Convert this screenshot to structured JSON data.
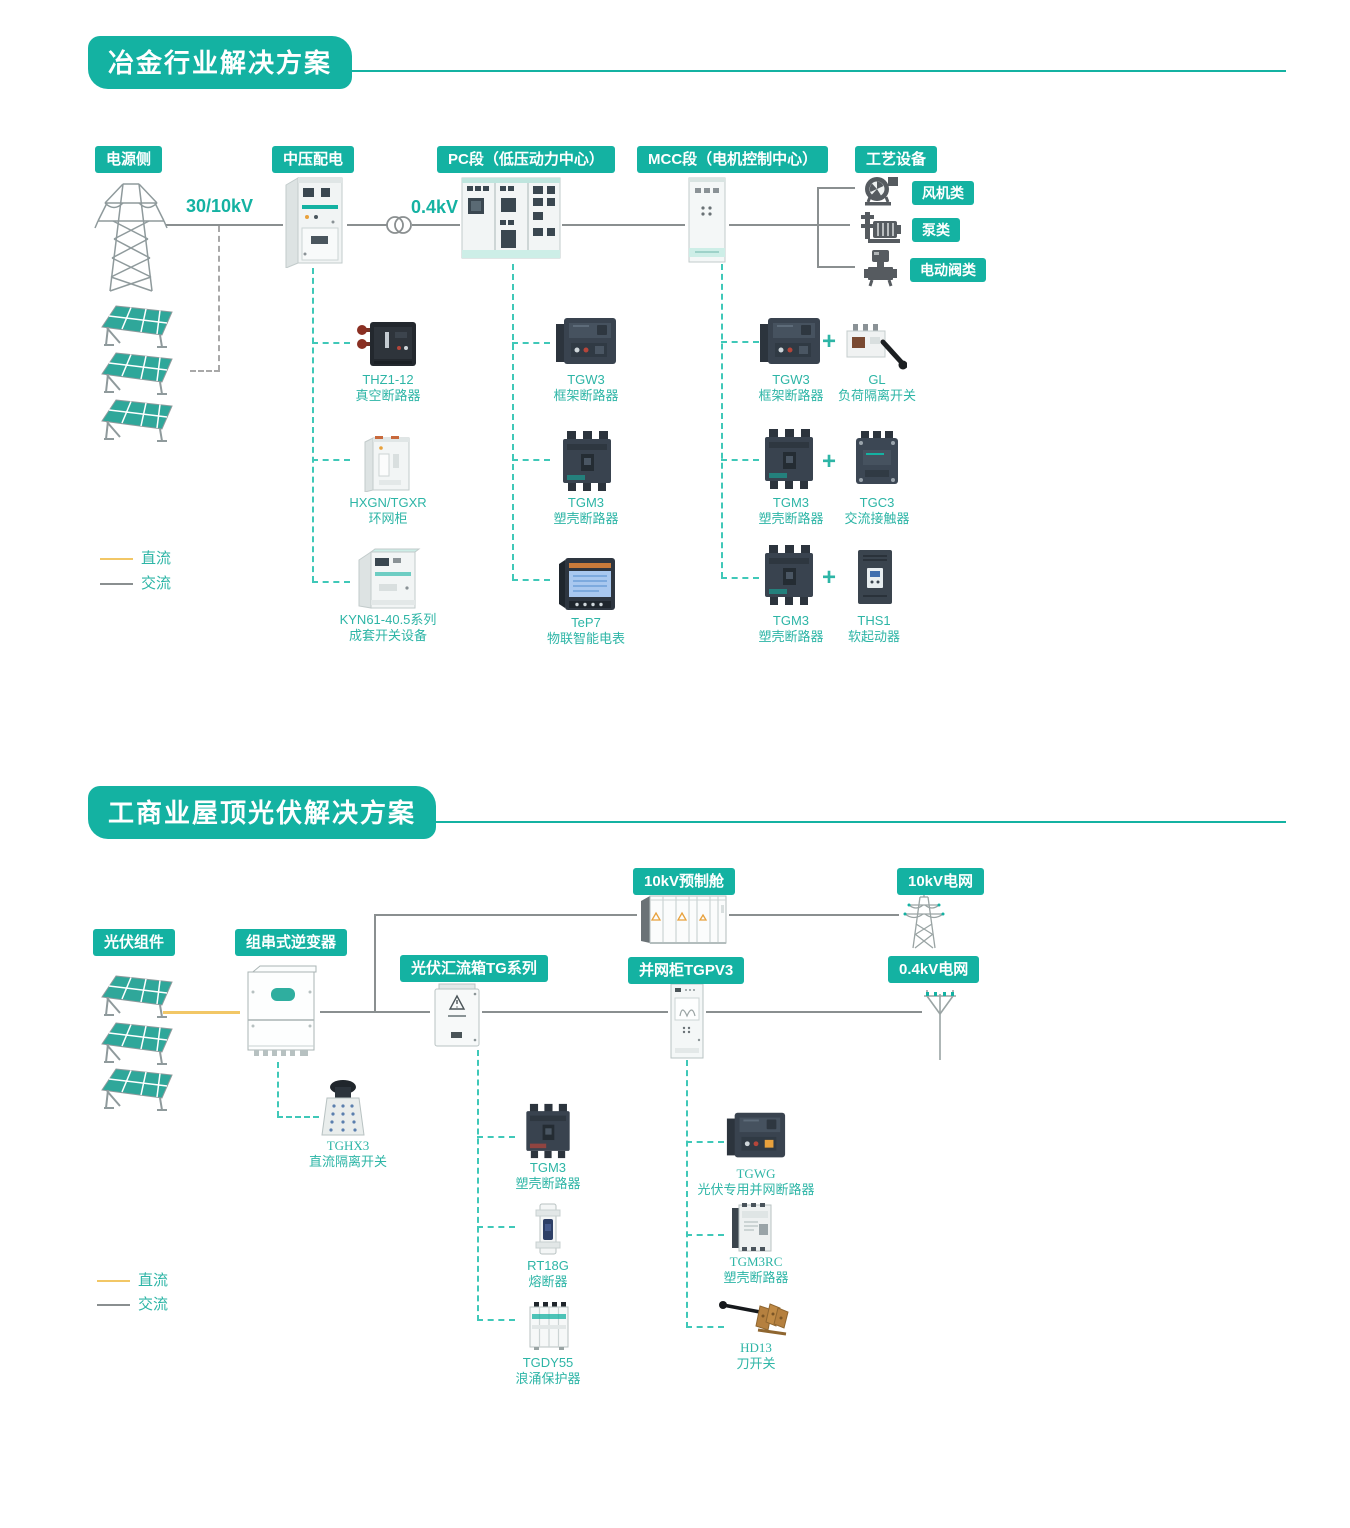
{
  "colors": {
    "accent": "#14b2a2",
    "product_label": "#2db5a6",
    "dc_line": "#f2c766",
    "ac_line": "#8a8f90",
    "teal_dash": "#3fc8b8"
  },
  "s1": {
    "title": "冶金行业解决方案",
    "badges": {
      "power": "电源侧",
      "mv": "中压配电",
      "pc": "PC段（低压动力中心）",
      "mcc": "MCC段（电机控制中心）",
      "process": "工艺设备"
    },
    "voltage_in": "30/10kV",
    "voltage_out": "0.4kV",
    "process_types": [
      {
        "label": "风机类",
        "icon": "fan-icon"
      },
      {
        "label": "泵类",
        "icon": "pump-icon"
      },
      {
        "label": "电动阀类",
        "icon": "motor-valve-icon"
      }
    ],
    "mv_products": [
      {
        "model": "THZ1-12",
        "name": "真空断路器"
      },
      {
        "model": "HXGN/TGXR",
        "name": "环网柜"
      },
      {
        "model": "KYN61-40.5系列",
        "name": "成套开关设备"
      }
    ],
    "pc_products": [
      {
        "model": "TGW3",
        "name": "框架断路器"
      },
      {
        "model": "TGM3",
        "name": "塑壳断路器"
      },
      {
        "model": "TeP7",
        "name": "物联智能电表"
      }
    ],
    "mcc_rows": [
      {
        "breaker_model": "TGW3",
        "breaker_name": "框架断路器",
        "plus": "+",
        "pair_model": "GL",
        "pair_name": "负荷隔离开关"
      },
      {
        "breaker_model": "TGM3",
        "breaker_name": "塑壳断路器",
        "plus": "+",
        "pair_model": "TGC3",
        "pair_name": "交流接触器"
      },
      {
        "breaker_model": "TGM3",
        "breaker_name": "塑壳断路器",
        "plus": "+",
        "pair_model": "THS1",
        "pair_name": "软起动器"
      }
    ],
    "legend": {
      "dc": "直流",
      "ac": "交流"
    }
  },
  "s2": {
    "title": "工商业屋顶光伏解决方案",
    "badges": {
      "pv": "光伏组件",
      "inverter": "组串式逆变器",
      "combiner": "光伏汇流箱TG系列",
      "grid_cabinet": "并网柜TGPV3",
      "prefab": "10kV预制舱",
      "grid10": "10kV电网",
      "grid04": "0.4kV电网"
    },
    "inverter_product": {
      "model": "TGHX3",
      "name": "直流隔离开关"
    },
    "combiner_products": [
      {
        "model": "TGM3",
        "name": "塑壳断路器"
      },
      {
        "model": "RT18G",
        "name": "熔断器"
      },
      {
        "model": "TGDY55",
        "name": "浪涌保护器"
      }
    ],
    "grid_products": [
      {
        "model": "TGWG",
        "name": "光伏专用并网断路器"
      },
      {
        "model": "TGM3RC",
        "name": "塑壳断路器"
      },
      {
        "model": "HD13",
        "name": "刀开关"
      }
    ],
    "legend": {
      "dc": "直流",
      "ac": "交流"
    }
  }
}
